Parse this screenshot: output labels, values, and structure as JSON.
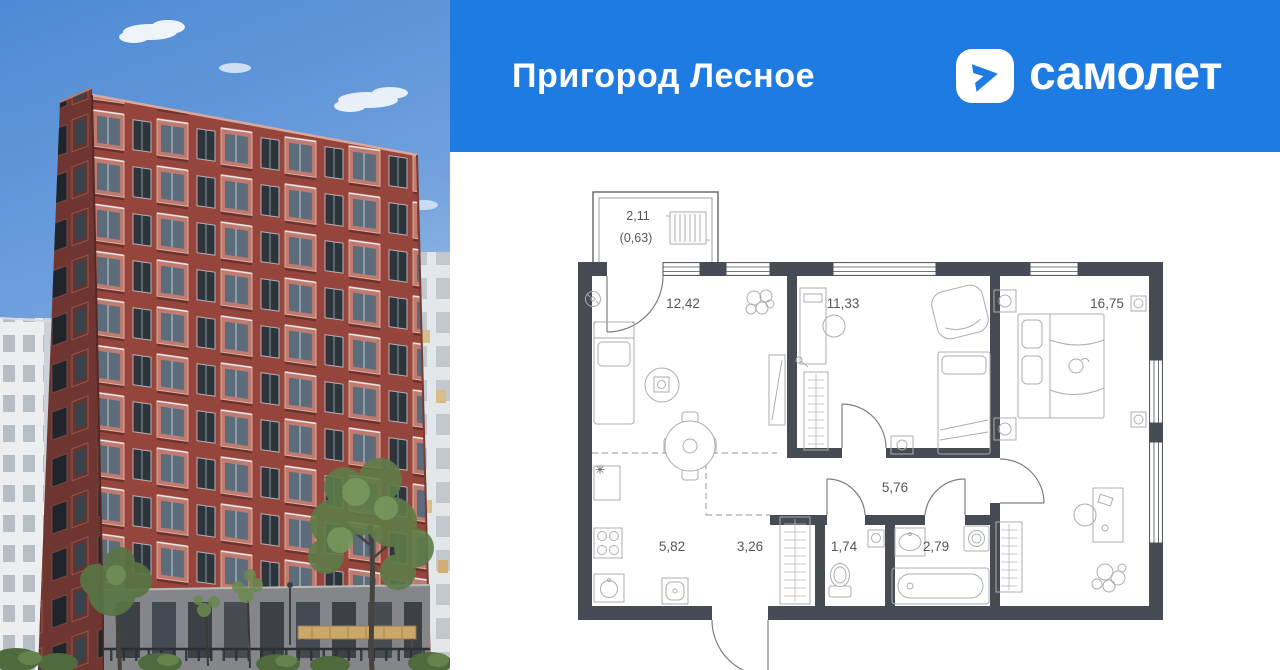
{
  "banner": {
    "project_name": "Пригород Лесное",
    "brand_wordmark": "самолет",
    "background_color": "#1d7be1"
  },
  "floor_plan": {
    "wall_color": "#474c54",
    "balcony": {
      "area": "2,11",
      "area_with_coefficient": "(0,63)"
    },
    "rooms": {
      "living": "12,42",
      "bedroom1": "11,33",
      "bedroom2": "16,75",
      "corridor": "5,76",
      "kitchen": "5,82",
      "hallway": "3,26",
      "wc": "1,74",
      "bathroom": "2,79"
    },
    "symbols": {
      "vent": "✳"
    }
  }
}
